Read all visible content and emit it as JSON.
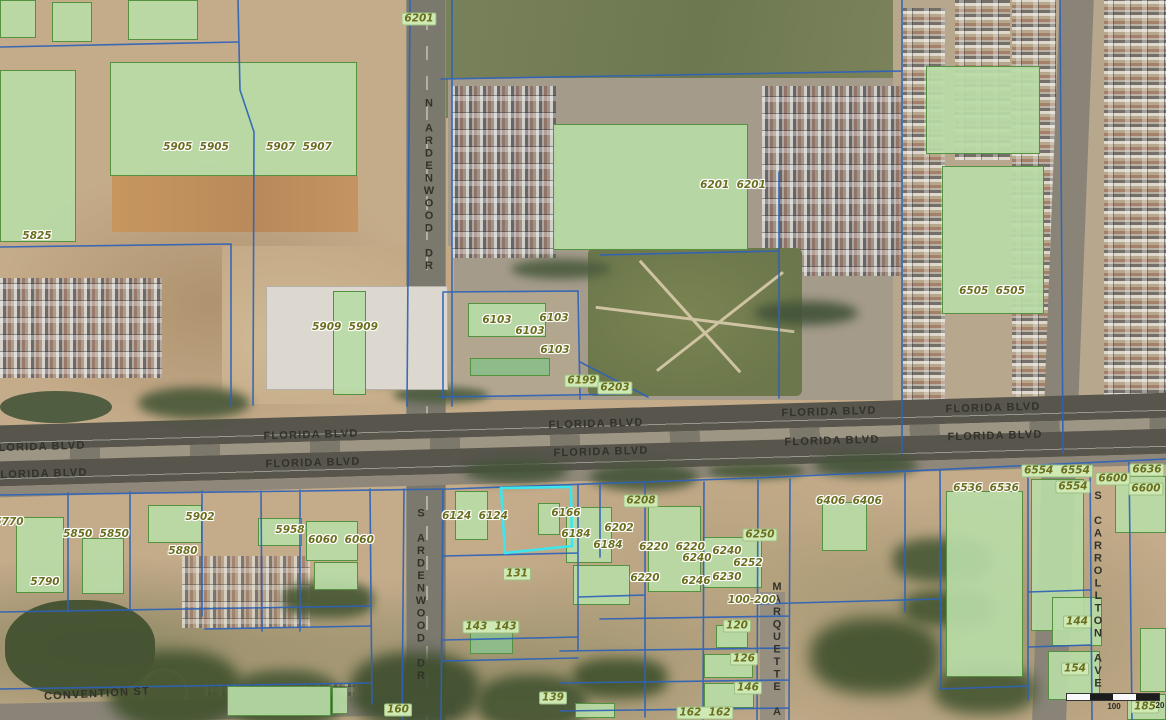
{
  "map": {
    "selected_parcel_id": "6166",
    "colors": {
      "parcel_line": "#2e62b8",
      "selection": "#3be6ee",
      "building_fill": "#b7dba6",
      "building_stroke": "#55923f",
      "parcel_label_text": "#6a6e1e",
      "parcel_label_box": "#cfe9b4",
      "street_label_text": "#32322a"
    },
    "street_labels": [
      {
        "text": "FLORIDA BLVD",
        "x": 38,
        "y": 447,
        "rot": -1.6
      },
      {
        "text": "FLORIDA BLVD",
        "x": 40,
        "y": 474,
        "rot": -1.6
      },
      {
        "text": "FLORIDA BLVD",
        "x": 311,
        "y": 435,
        "rot": -1.6
      },
      {
        "text": "FLORIDA BLVD",
        "x": 313,
        "y": 463,
        "rot": -1.6
      },
      {
        "text": "FLORIDA BLVD",
        "x": 596,
        "y": 424,
        "rot": -1.6
      },
      {
        "text": "FLORIDA BLVD",
        "x": 601,
        "y": 452,
        "rot": -1.6
      },
      {
        "text": "FLORIDA BLVD",
        "x": 829,
        "y": 412,
        "rot": -1.6
      },
      {
        "text": "FLORIDA BLVD",
        "x": 832,
        "y": 441,
        "rot": -1.6
      },
      {
        "text": "FLORIDA BLVD",
        "x": 993,
        "y": 408,
        "rot": -1.6
      },
      {
        "text": "FLORIDA BLVD",
        "x": 995,
        "y": 436,
        "rot": -1.6
      },
      {
        "text": "N ARDENWOOD DR",
        "x": 429,
        "y": 185,
        "vertical": true
      },
      {
        "text": "S ARDENWOOD DR",
        "x": 421,
        "y": 595,
        "vertical": true
      },
      {
        "text": "MARQUETTE AVE",
        "x": 777,
        "y": 662,
        "vertical": true
      },
      {
        "text": "S CARROLLTON AVE",
        "x": 1098,
        "y": 590,
        "vertical": true
      },
      {
        "text": "CONVENTION ST",
        "x": 97,
        "y": 694,
        "rot": -3
      }
    ],
    "parcel_labels": [
      {
        "text": "6201",
        "x": 419,
        "y": 19,
        "boxed": true
      },
      {
        "text": "5905  5905",
        "x": 196,
        "y": 147
      },
      {
        "text": "5907  5907",
        "x": 299,
        "y": 147
      },
      {
        "text": "5825",
        "x": 37,
        "y": 236
      },
      {
        "text": "5909  5909",
        "x": 345,
        "y": 327
      },
      {
        "text": "6103",
        "x": 497,
        "y": 320
      },
      {
        "text": "6103",
        "x": 554,
        "y": 318
      },
      {
        "text": "6103",
        "x": 530,
        "y": 331
      },
      {
        "text": "6103",
        "x": 555,
        "y": 350
      },
      {
        "text": "6199",
        "x": 582,
        "y": 381,
        "boxed": true
      },
      {
        "text": "6203",
        "x": 615,
        "y": 388,
        "boxed": true
      },
      {
        "text": "6201  6201",
        "x": 733,
        "y": 185
      },
      {
        "text": "6505  6505",
        "x": 992,
        "y": 291
      },
      {
        "text": "6554  6554",
        "x": 1057,
        "y": 471,
        "boxed": true
      },
      {
        "text": "6554",
        "x": 1073,
        "y": 487,
        "boxed": true
      },
      {
        "text": "6536  6536",
        "x": 986,
        "y": 488
      },
      {
        "text": "6636",
        "x": 1147,
        "y": 470,
        "boxed": true
      },
      {
        "text": "6600",
        "x": 1113,
        "y": 479,
        "boxed": true
      },
      {
        "text": "6600",
        "x": 1146,
        "y": 489,
        "boxed": true
      },
      {
        "text": "6406  6406",
        "x": 849,
        "y": 501
      },
      {
        "text": "5902",
        "x": 200,
        "y": 517
      },
      {
        "text": "5850  5850",
        "x": 96,
        "y": 534
      },
      {
        "text": "5880",
        "x": 183,
        "y": 551
      },
      {
        "text": "5790",
        "x": 45,
        "y": 582
      },
      {
        "text": "5770",
        "x": 9,
        "y": 522
      },
      {
        "text": "5958",
        "x": 290,
        "y": 530
      },
      {
        "text": "6060  6060",
        "x": 341,
        "y": 540
      },
      {
        "text": "6124  6124",
        "x": 475,
        "y": 516
      },
      {
        "text": "6166",
        "x": 566,
        "y": 513
      },
      {
        "text": "6184",
        "x": 576,
        "y": 534
      },
      {
        "text": "6184",
        "x": 608,
        "y": 545
      },
      {
        "text": "6202",
        "x": 619,
        "y": 528
      },
      {
        "text": "6208",
        "x": 641,
        "y": 501,
        "boxed": true
      },
      {
        "text": "6220  6220",
        "x": 672,
        "y": 547
      },
      {
        "text": "6240",
        "x": 697,
        "y": 558
      },
      {
        "text": "6240",
        "x": 727,
        "y": 551
      },
      {
        "text": "6250",
        "x": 760,
        "y": 535,
        "boxed": true
      },
      {
        "text": "6252",
        "x": 748,
        "y": 563
      },
      {
        "text": "6246",
        "x": 696,
        "y": 581
      },
      {
        "text": "6230",
        "x": 727,
        "y": 577
      },
      {
        "text": "6220",
        "x": 645,
        "y": 578
      },
      {
        "text": "100-200",
        "x": 752,
        "y": 600
      },
      {
        "text": "131",
        "x": 517,
        "y": 574,
        "boxed": true
      },
      {
        "text": "143  143",
        "x": 491,
        "y": 627,
        "boxed": true
      },
      {
        "text": "120",
        "x": 737,
        "y": 626,
        "boxed": true
      },
      {
        "text": "126",
        "x": 744,
        "y": 659,
        "boxed": true
      },
      {
        "text": "146",
        "x": 748,
        "y": 688,
        "boxed": true
      },
      {
        "text": "162  162",
        "x": 705,
        "y": 713,
        "boxed": true
      },
      {
        "text": "139",
        "x": 553,
        "y": 698,
        "boxed": true
      },
      {
        "text": "160",
        "x": 398,
        "y": 710,
        "boxed": true
      },
      {
        "text": "144",
        "x": 1077,
        "y": 622,
        "boxed": true
      },
      {
        "text": "154",
        "x": 1075,
        "y": 669,
        "boxed": true
      },
      {
        "text": "185",
        "x": 1145,
        "y": 707,
        "boxed": true
      }
    ],
    "scale_bar": {
      "labels": [
        {
          "text": "100",
          "x": 1114,
          "y": 702
        },
        {
          "text": "20",
          "x": 1160,
          "y": 701
        }
      ]
    }
  }
}
